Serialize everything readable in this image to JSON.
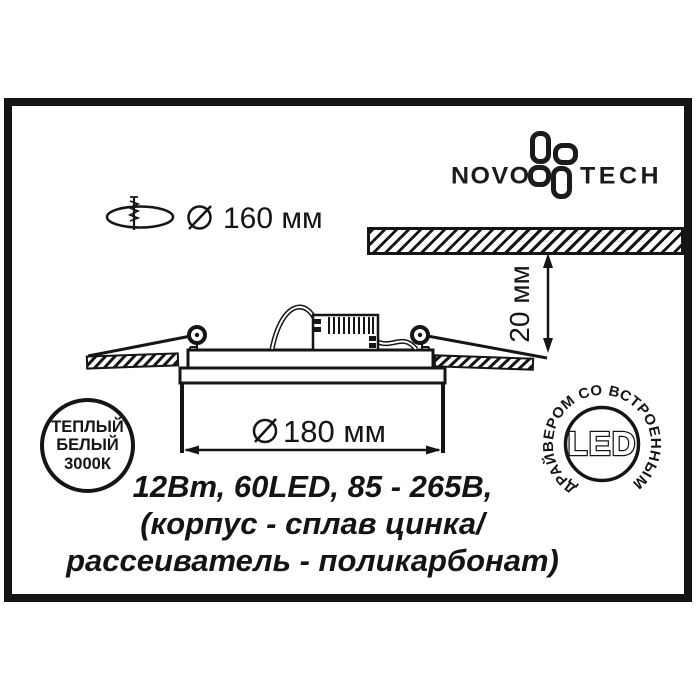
{
  "colors": {
    "ink": "#151515",
    "bg": "#ffffff"
  },
  "brand": {
    "word_left": "NOVO",
    "word_right": "TECH"
  },
  "labels": {
    "hole_diameter": "160 мм",
    "body_diameter": "180 мм",
    "depth": "20 мм"
  },
  "warm_badge": {
    "line1": "ТЕПЛЫЙ",
    "line2": "БЕЛЫЙ",
    "line3": "3000К"
  },
  "led_badge": {
    "center": "LED",
    "ring": "ДРАЙВЕРОМ СО ВСТРОЕННЫМ"
  },
  "specs": {
    "line1": "12Вт, 60LED, 85 - 265В,",
    "line2": "(корпус - сплав цинка/",
    "line3": "рассеиватель - поликарбонат)"
  }
}
